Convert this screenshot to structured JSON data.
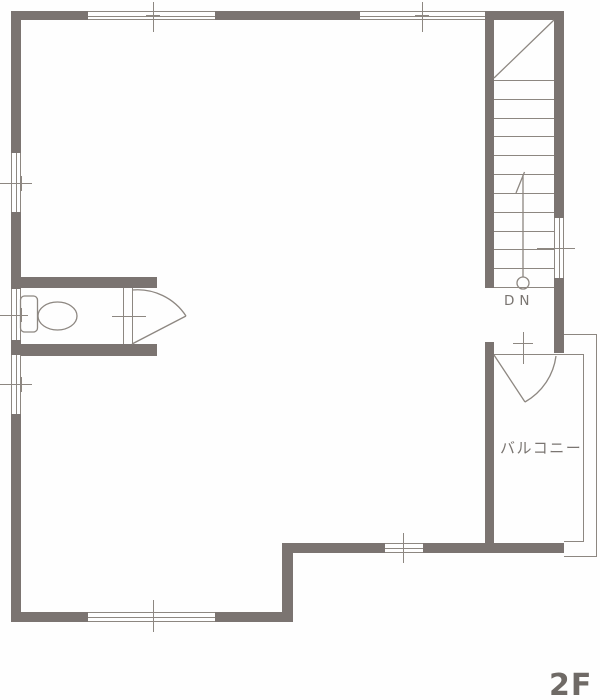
{
  "title": "2F floor plan",
  "colors": {
    "wall": "#7b7471",
    "line": "#8d8781",
    "text": "#7a7571",
    "floortext": "#6f6a66",
    "bg": "#fefefe"
  },
  "labels": {
    "stairs_direction": "DN",
    "balcony": "バルコニー",
    "floor": "2F"
  },
  "stairs": {
    "tread_count": 12,
    "direction": "down",
    "marker": "circle-with-up-line"
  },
  "fixtures": [
    {
      "name": "toilet",
      "room": "wc"
    },
    {
      "name": "hinged-door",
      "location": "wc"
    },
    {
      "name": "hinged-door",
      "location": "balcony"
    }
  ]
}
